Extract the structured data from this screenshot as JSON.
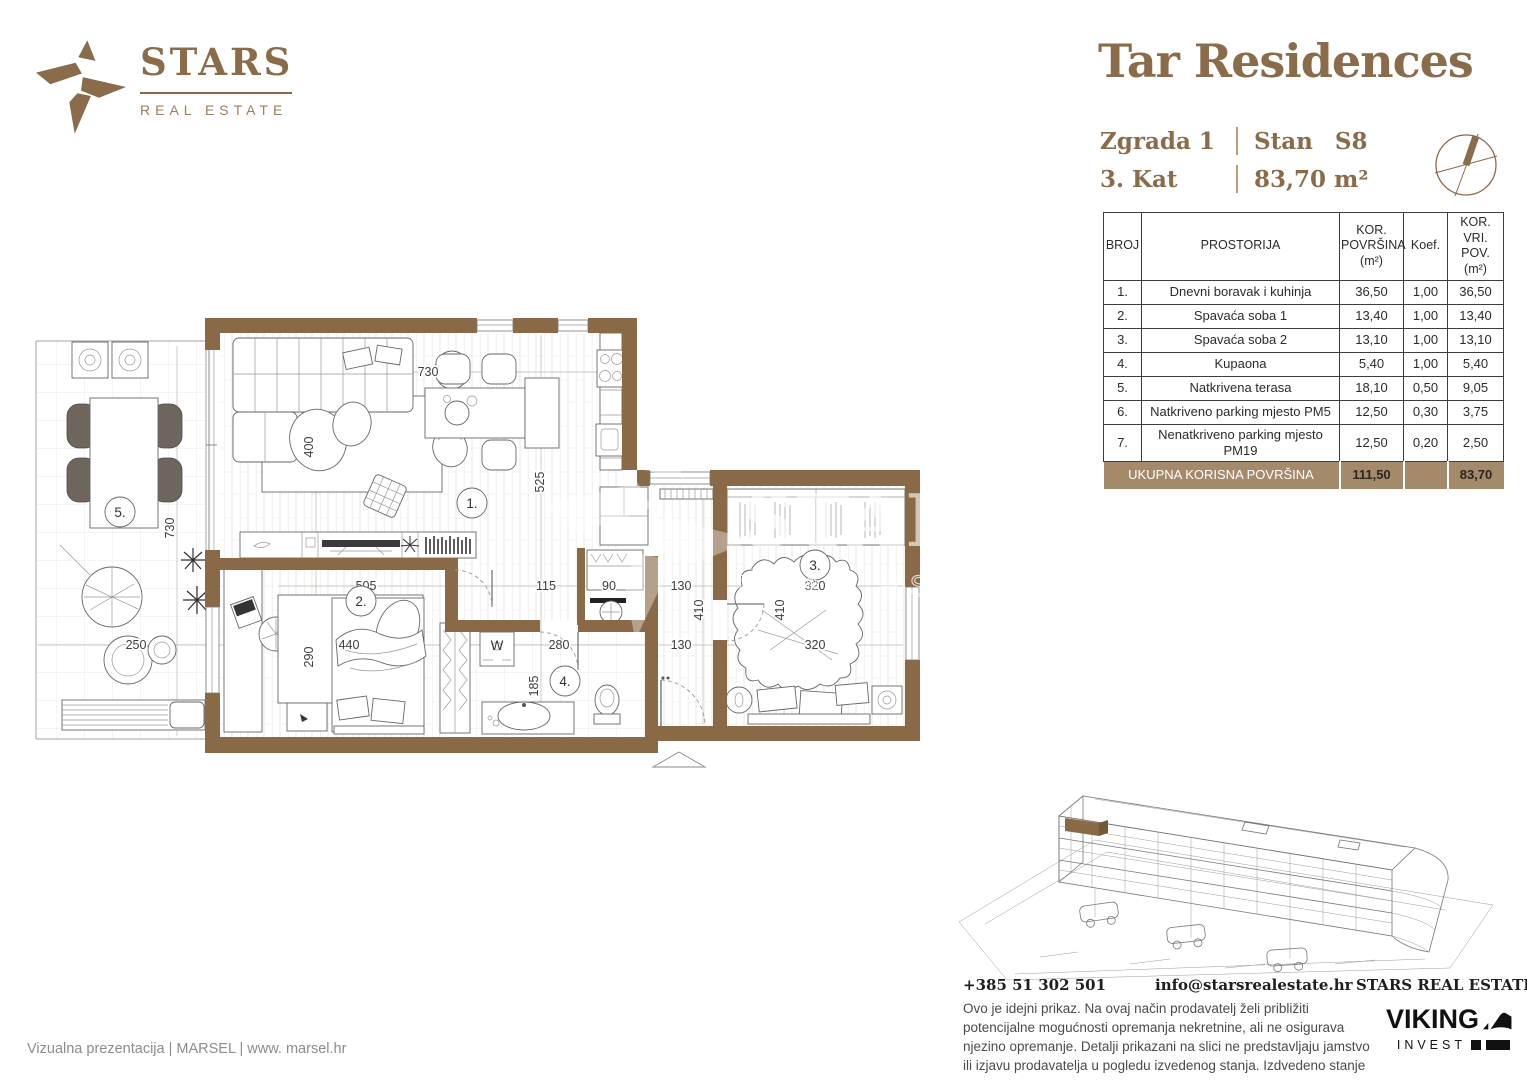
{
  "brand": {
    "word": "STARS",
    "sub": "REAL ESTATE"
  },
  "header": {
    "title": "Tar Residences",
    "building_label": "Zgrada 1",
    "unit_label": "Stan",
    "unit_value": "S8",
    "floor_label": "3. Kat",
    "area_value": "83,70 m²"
  },
  "table": {
    "header_lines": [
      [
        "BROJ"
      ],
      [
        "PROSTORIJA"
      ],
      [
        "KOR.",
        "POVRŠINA",
        "(m²)"
      ],
      [
        "Koef."
      ],
      [
        "KOR.",
        "VRI. POV.",
        "(m²)"
      ]
    ],
    "rows": [
      {
        "num": "1.",
        "name": "Dnevni boravak i kuhinja",
        "area": "36,50",
        "koef": "1,00",
        "value": "36,50"
      },
      {
        "num": "2.",
        "name": "Spavaća soba 1",
        "area": "13,40",
        "koef": "1,00",
        "value": "13,40"
      },
      {
        "num": "3.",
        "name": "Spavaća soba 2",
        "area": "13,10",
        "koef": "1,00",
        "value": "13,10"
      },
      {
        "num": "4.",
        "name": "Kupaona",
        "area": "5,40",
        "koef": "1,00",
        "value": "5,40"
      },
      {
        "num": "5.",
        "name": "Natkrivena terasa",
        "area": "18,10",
        "koef": "0,50",
        "value": "9,05"
      },
      {
        "num": "6.",
        "name": "Natkriveno parking mjesto PM5",
        "area": "12,50",
        "koef": "0,30",
        "value": "3,75"
      },
      {
        "num": "7.",
        "name": "Nenatkriveno parking mjesto PM19",
        "area": "12,50",
        "koef": "0,20",
        "value": "2,50"
      }
    ],
    "total": {
      "label": "UKUPNA KORISNA POVRŠINA",
      "area": "111,50",
      "value": "83,70"
    }
  },
  "floorplan": {
    "rooms": {
      "living": "1.",
      "bed2": "2.",
      "bed3": "3.",
      "bath": "4.",
      "terrace": "5."
    },
    "dims": {
      "living_w": "730",
      "living_h": "400",
      "kitchen_h": "525",
      "terrace_h": "730",
      "terrace_w": "250",
      "bed2_w": "505",
      "bed2_h": "290",
      "bed2_bed": "440",
      "hall_w": "115",
      "closet_w": "90",
      "bath_w": "280",
      "bath_h": "185",
      "hall2_w": "130",
      "hall2_h": "410",
      "hall3_w": "130",
      "bed3_w": "320",
      "bed3_h": "410",
      "bed3_w2": "320"
    },
    "watermark": {
      "word": "STARS",
      "sub": "REAL ESTATE"
    },
    "washer_label": "W"
  },
  "footer": {
    "phone": "+385 51 302 501",
    "email": "info@starsrealestate.hr",
    "company": "STARS REAL ESTATE d.o.o.",
    "disclaimer": "Ovo je idejni prikaz. Na ovaj način prodavatelj želi približiti potencijalne mogućnosti opremanja nekretnine, ali ne osigurava njezino opremanje. Detalji prikazani na slici ne predstavljaju jamstvo ili izjavu prodavatelja u pogledu izvedenog stanja. Izdvedeno stanje može varirati.",
    "credit": "Vizualna prezentacija | MARSEL | www. marsel.hr",
    "viking_name": "VIKING",
    "viking_sub": "INVEST"
  },
  "colors": {
    "brown": "#8a6b4a",
    "wall": "#8a6a46",
    "totalbg": "#a5896b",
    "ink": "#2b2b2b"
  }
}
